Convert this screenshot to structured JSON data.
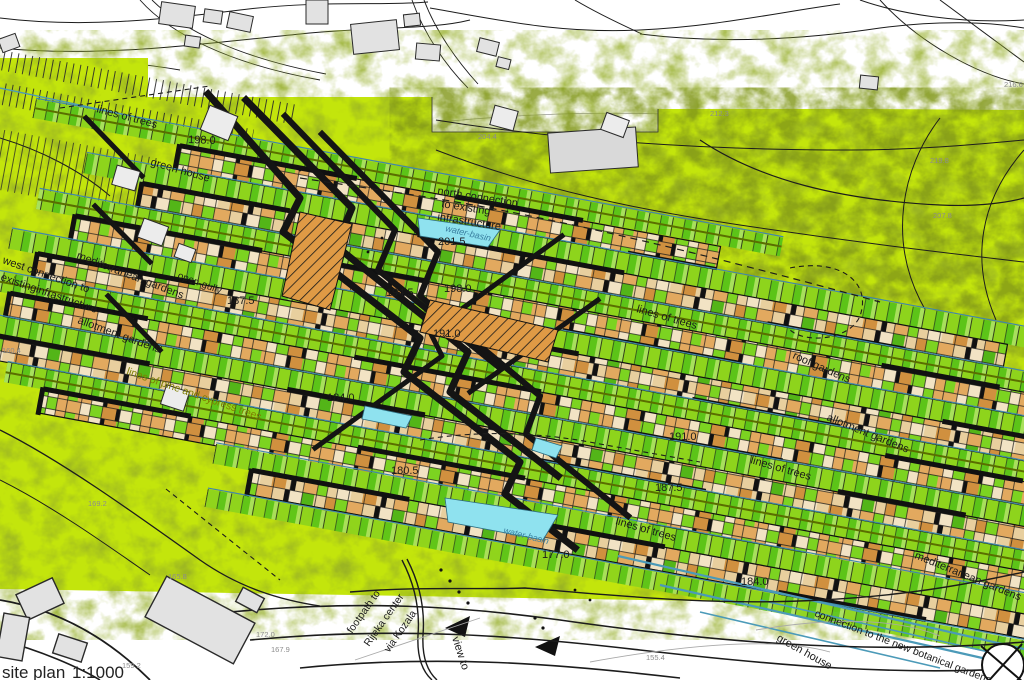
{
  "map": {
    "title": "site plan",
    "scale": "1:1000",
    "type": "urban design site plan with terraced housing rows over aerial photo"
  },
  "colors": {
    "site_green": "#c3e50c",
    "dark_green": "#4d6b02",
    "plot_green": "#7ccf1d",
    "plot_green_dark": "#53b518",
    "house_tan": "#e2a95f",
    "house_orange": "#d0903f",
    "house_cream": "#f2e3c4",
    "water_cyan": "#8fe2ef",
    "channel_blue": "#3f88aa",
    "ink": "#1b1b1b",
    "building_gray": "#e2e2e2",
    "label_gray": "#8c8c8c",
    "pine_label_olive": "#7e7e00",
    "water_label_blue": "#3a7fa0"
  },
  "labels": [
    {
      "text": "lines of trees",
      "x": 96,
      "y": 112,
      "r": 15,
      "size": 11
    },
    {
      "text": "198.0",
      "x": 188,
      "y": 143,
      "r": 2,
      "size": 11
    },
    {
      "text": "green house",
      "x": 150,
      "y": 165,
      "r": 16,
      "size": 11
    },
    {
      "text": "north connection",
      "x": 437,
      "y": 194,
      "r": 9,
      "size": 11
    },
    {
      "text": "to existing",
      "x": 441,
      "y": 207,
      "r": 9,
      "size": 11
    },
    {
      "text": "infrastructure",
      "x": 437,
      "y": 220,
      "r": 9,
      "size": 11
    },
    {
      "text": "water-basin",
      "x": 445,
      "y": 231,
      "r": 13,
      "size": 9,
      "italic": true,
      "color": "#3a7fa0",
      "name": "water-basin-label"
    },
    {
      "text": "201.5",
      "x": 438,
      "y": 245,
      "r": 0,
      "size": 11
    },
    {
      "text": "west connection to",
      "x": 2,
      "y": 263,
      "r": 19,
      "size": 11
    },
    {
      "text": "existinginfrastructure",
      "x": 0,
      "y": 280,
      "r": 19,
      "size": 11
    },
    {
      "text": "mediterranean gardens",
      "x": 76,
      "y": 258,
      "r": 21,
      "size": 11
    },
    {
      "text": "open-gully",
      "x": 177,
      "y": 278,
      "r": 20,
      "size": 10
    },
    {
      "text": "187.5",
      "x": 227,
      "y": 304,
      "r": 0,
      "size": 11
    },
    {
      "text": "194.5",
      "x": 386,
      "y": 296,
      "r": 0,
      "size": 11
    },
    {
      "text": "198.0",
      "x": 444,
      "y": 292,
      "r": 0,
      "size": 11
    },
    {
      "text": "191.0",
      "x": 433,
      "y": 337,
      "r": 0,
      "size": 11
    },
    {
      "text": "lines of trees",
      "x": 636,
      "y": 312,
      "r": 16,
      "size": 11
    },
    {
      "text": "roof gardens",
      "x": 792,
      "y": 358,
      "r": 24,
      "size": 11
    },
    {
      "text": "allotment gardens",
      "x": 77,
      "y": 323,
      "r": 20,
      "size": 11
    },
    {
      "text": "lines of pine and cypress trees",
      "x": 126,
      "y": 374,
      "r": 19,
      "size": 10.5,
      "color": "#7e7e00",
      "name": "pine-trees-label"
    },
    {
      "text": "184.0",
      "x": 327,
      "y": 401,
      "r": 0,
      "size": 11
    },
    {
      "text": "180.5",
      "x": 391,
      "y": 474,
      "r": 0,
      "size": 11
    },
    {
      "text": "allotment gardens",
      "x": 826,
      "y": 420,
      "r": 22,
      "size": 11
    },
    {
      "text": "191.0",
      "x": 669,
      "y": 440,
      "r": 0,
      "size": 11
    },
    {
      "text": "lines of trees",
      "x": 750,
      "y": 463,
      "r": 16,
      "size": 11
    },
    {
      "text": "187.5",
      "x": 655,
      "y": 491,
      "r": 0,
      "size": 11
    },
    {
      "text": "water-basin",
      "x": 503,
      "y": 533,
      "r": 14,
      "size": 9,
      "italic": true,
      "color": "#3a7fa0",
      "name": "water-basin-label"
    },
    {
      "text": "177.0",
      "x": 542,
      "y": 558,
      "r": 0,
      "size": 11
    },
    {
      "text": "lines of trees",
      "x": 615,
      "y": 524,
      "r": 16,
      "size": 11
    },
    {
      "text": "mediterranean gardens",
      "x": 914,
      "y": 558,
      "r": 22,
      "size": 11
    },
    {
      "text": "184.0",
      "x": 741,
      "y": 585,
      "r": 0,
      "size": 11
    },
    {
      "text": "footpath to",
      "x": 352,
      "y": 634,
      "r": -55,
      "size": 10.5
    },
    {
      "text": "Rijeka center",
      "x": 369,
      "y": 647,
      "r": -55,
      "size": 10.5
    },
    {
      "text": "via Kozala",
      "x": 389,
      "y": 653,
      "r": -55,
      "size": 10.5
    },
    {
      "text": "view to",
      "x": 452,
      "y": 638,
      "r": 72,
      "size": 11
    },
    {
      "text": "connection to the new botanical gardens",
      "x": 814,
      "y": 616,
      "r": 21,
      "size": 10.5
    },
    {
      "text": "green house",
      "x": 776,
      "y": 640,
      "r": 29,
      "size": 11
    },
    {
      "text": "204.4",
      "x": 478,
      "y": 139,
      "r": 0,
      "size": 7.5,
      "color": "#8c8c8c",
      "name": "elevation-mark"
    },
    {
      "text": "212.3",
      "x": 710,
      "y": 116,
      "r": 0,
      "size": 7.5,
      "color": "#8c8c8c",
      "name": "elevation-mark"
    },
    {
      "text": "216.6",
      "x": 1004,
      "y": 87,
      "r": 0,
      "size": 7.5,
      "color": "#8c8c8c",
      "name": "elevation-mark"
    },
    {
      "text": "219.8",
      "x": 930,
      "y": 163,
      "r": 0,
      "size": 7.5,
      "color": "#8c8c8c",
      "name": "elevation-mark"
    },
    {
      "text": "207.8",
      "x": 933,
      "y": 218,
      "r": 0,
      "size": 7.5,
      "color": "#8c8c8c",
      "name": "elevation-mark"
    },
    {
      "text": "160.4",
      "x": 2,
      "y": 353,
      "r": 0,
      "size": 7.5,
      "color": "#8c8c8c",
      "name": "elevation-mark"
    },
    {
      "text": "169.2",
      "x": 88,
      "y": 506,
      "r": 0,
      "size": 7.5,
      "color": "#8c8c8c",
      "name": "elevation-mark"
    },
    {
      "text": "165.8",
      "x": 168,
      "y": 579,
      "r": 0,
      "size": 7.5,
      "color": "#8c8c8c",
      "name": "elevation-mark"
    },
    {
      "text": "172.0",
      "x": 256,
      "y": 637,
      "r": 0,
      "size": 7.5,
      "color": "#8c8c8c",
      "name": "elevation-mark"
    },
    {
      "text": "167.9",
      "x": 271,
      "y": 652,
      "r": 0,
      "size": 7.5,
      "color": "#8c8c8c",
      "name": "elevation-mark"
    },
    {
      "text": "159.2",
      "x": 122,
      "y": 668,
      "r": 0,
      "size": 7.5,
      "color": "#8c8c8c",
      "name": "elevation-mark"
    },
    {
      "text": "155.4",
      "x": 646,
      "y": 660,
      "r": 0,
      "size": 7.5,
      "color": "#8c8c8c",
      "name": "elevation-mark"
    }
  ]
}
